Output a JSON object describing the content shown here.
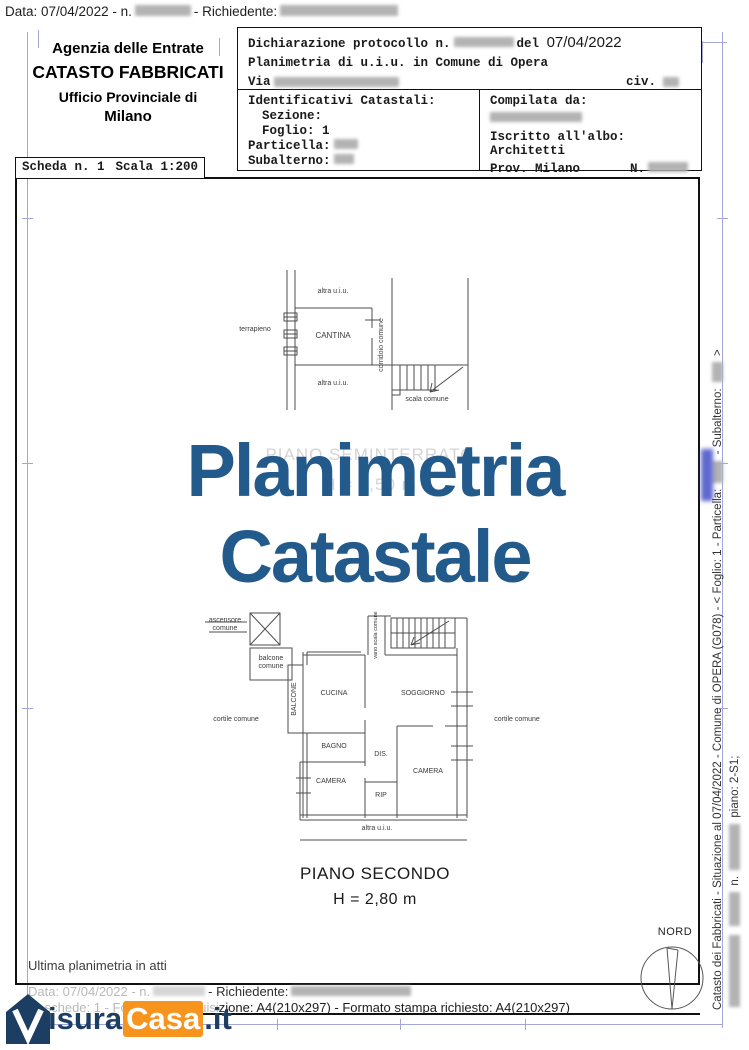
{
  "colors": {
    "watermark": "#235A8C",
    "logo_navy": "#1C3E63",
    "logo_orange": "#F7941E",
    "guide_blue": "#a3a6d8"
  },
  "top_bar": {
    "data_label": "Data: 07/04/2022 - n.",
    "richiedente_label": "- Richiedente:"
  },
  "agency": {
    "line1": "Agenzia delle Entrate",
    "line2": "CATASTO FABBRICATI",
    "line3": "Ufficio Provinciale di",
    "line4": "Milano"
  },
  "declaration": {
    "protocol": "Dichiarazione protocollo n.",
    "del": "del",
    "date": "07/04/2022",
    "subject": "Planimetria di u.i.u. in Comune di Opera",
    "via": "Via",
    "civ": "civ."
  },
  "identifiers": {
    "title": "Identificativi Catastali:",
    "sezione": "Sezione:",
    "foglio": "Foglio: 1",
    "particella": "Particella:",
    "subalterno": "Subalterno:"
  },
  "compiler": {
    "title": "Compilata da:",
    "albo1": "Iscritto all'albo:",
    "albo2": "Architetti",
    "prov": "Prov. Milano",
    "n_label": "N."
  },
  "sheet": {
    "scheda": "Scheda n. 1",
    "scala": "Scala 1:200"
  },
  "watermark": {
    "line1": "Planimetria",
    "line2": "Catastale"
  },
  "seminterrato_caption": {
    "line1": "PIANO SEMINTERRATO",
    "line2": "H = 2,50 m"
  },
  "upper_plan": {
    "terrapieno": "terrapieno",
    "altra_top": "altra u.i.u.",
    "cantina": "CANTINA",
    "corridoio": "corridoio comune",
    "altra_bottom": "altra u.i.u.",
    "scala": "scala comune"
  },
  "lower_plan": {
    "ascensore": "ascensore comune",
    "balcone_comune": "balcone comune",
    "balcone": "BALCONE",
    "cucina": "CUCINA",
    "vano_scala": "vano scala comune",
    "soggiorno": "SOGGIORNO",
    "cortile_sx": "cortile comune",
    "cortile_dx": "cortile comune",
    "bagno": "BAGNO",
    "dis": "DIS.",
    "camera_sx": "CAMERA",
    "camera_dx": "CAMERA",
    "rip": "RIP",
    "altra": "altra u.i.u."
  },
  "floor_caption": {
    "line1": "PIANO SECONDO",
    "line2": "H = 2,80 m"
  },
  "compass": {
    "label": "NORD"
  },
  "side_text": {
    "part1": "Catasto dei Fabbricati - Situazione al 07/04/2022  -  Comune di OPERA (G078)  -  <  Foglio: 1 - Particella:",
    "part2": "- Subalterno:",
    "part3": ">",
    "inner_n": "n.",
    "inner_piano": "piano: 2-S1;"
  },
  "footer": {
    "ultima": "Ultima planimetria in atti",
    "data_label": "Data: 07/04/2022 - n.",
    "richiedente_label": "- Richiedente:",
    "formato_gray": "N. schede: 1 - Formato di acquisi",
    "formato_dark": "zione: A4(210x297)   - Formato stampa richiesto: A4(210x297)"
  },
  "logo": {
    "text1": "isura",
    "text2": "Casa",
    "text3": ".it"
  }
}
